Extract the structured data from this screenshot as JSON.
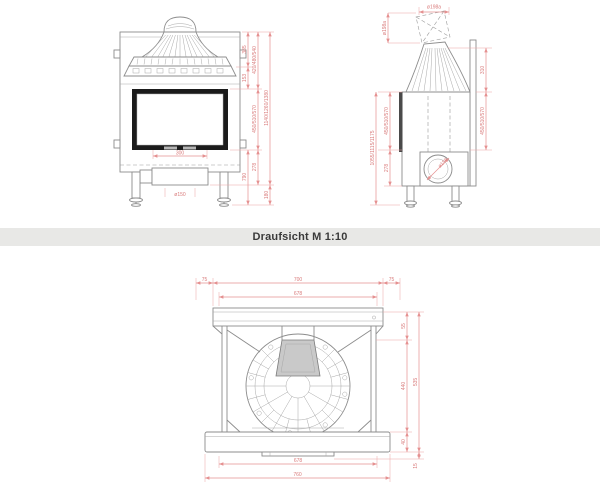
{
  "band": {
    "title": "Draufsicht M 1:10"
  },
  "colors": {
    "dimension_line": "#e59090",
    "dimension_text": "#d97b7b",
    "drawing_line": "#8c8c8c",
    "glass_frame": "#1b1b1b",
    "band_background": "#e8e8e6",
    "band_text": "#3a3a3a"
  },
  "front_view": {
    "dims": {
      "hood_height": "385",
      "collar_height": "153",
      "upper_variants": "420/480/540",
      "door_variants": "450/510/570",
      "total_variants": "1140/1260/1380",
      "base_height": "790",
      "duct_height": "278",
      "floor_clearance": "180",
      "duct_width": "300",
      "flue_diameter": "ø150"
    }
  },
  "side_view": {
    "dims": {
      "flue_top_diameter": "ø198a",
      "flue_side_diameter": "ø198a",
      "hood_depth": "310",
      "door_variants": "450/510/570",
      "left_door_variants": "450/510/570",
      "total_variants": "1055/1115/1175",
      "duct_height": "278",
      "outlet_diameter": "ø150"
    }
  },
  "top_view": {
    "dims": {
      "left_margin": "75",
      "body_width": "700",
      "right_margin": "75",
      "inner_width_top": "678",
      "rear_depth": "55",
      "body_depth": "440",
      "total_depth": "535",
      "front_depth": "40",
      "lip_depth": "15",
      "inner_width_bottom": "678",
      "front_width": "760"
    }
  }
}
